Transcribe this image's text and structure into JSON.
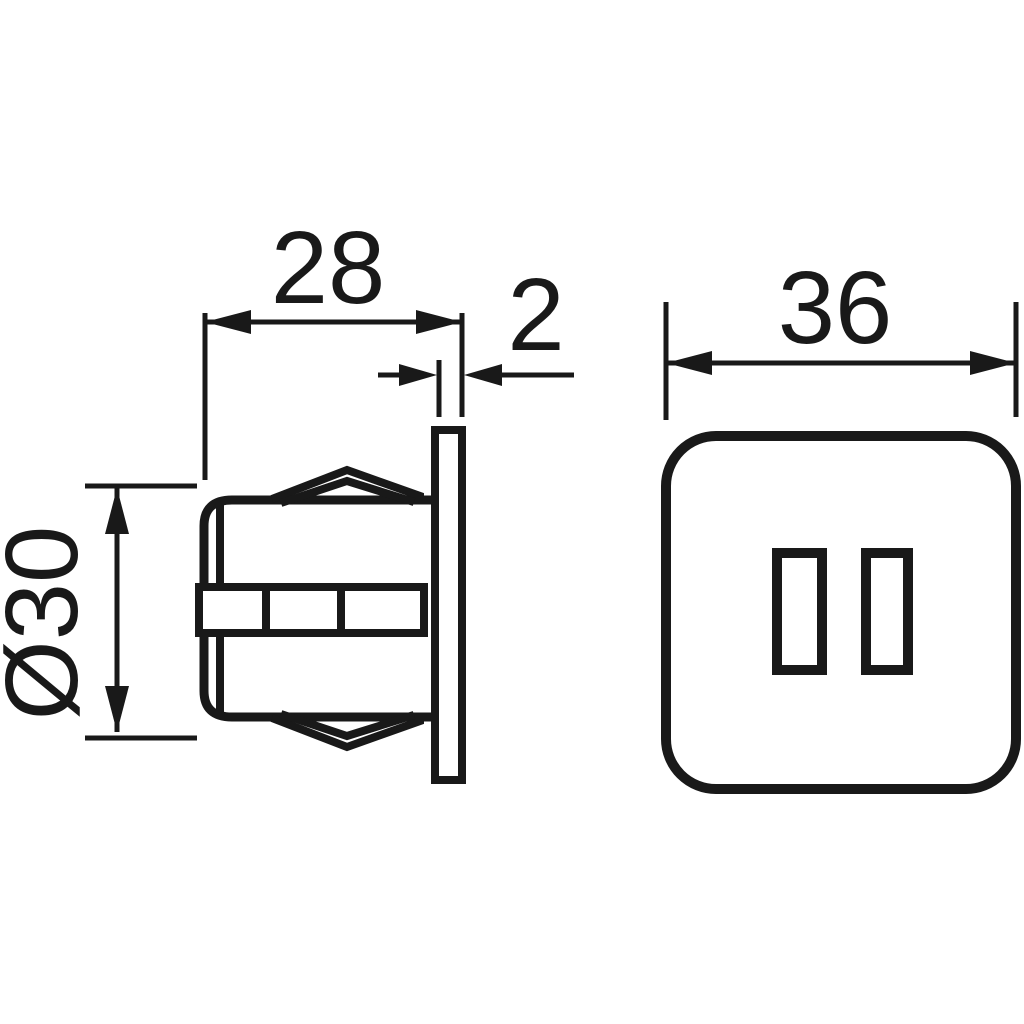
{
  "page": {
    "background": "#ffffff"
  },
  "drawing": {
    "line_color": "#191919",
    "dimension_labels": {
      "depth": "28",
      "flange_thickness": "2",
      "faceplate_size": "36",
      "diameter": "Ø30"
    }
  }
}
